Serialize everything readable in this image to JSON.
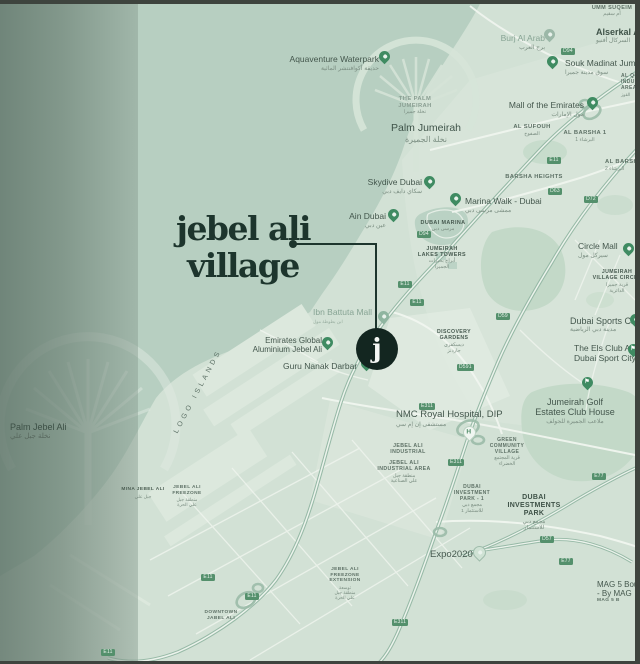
{
  "colors": {
    "accent_dark_green": "#1d352d",
    "pin_green": "#3f8b62",
    "badge_green": "#54906c",
    "water": "#b7cfc1",
    "land": "#d2e1d5",
    "marker_circle": "#132620"
  },
  "title": {
    "line1": "jebel ali",
    "line2": "village"
  },
  "icons": {
    "marker_letter": "j",
    "hospital": "H",
    "golf": "⚑"
  },
  "labels": {
    "aqua": {
      "text": "Aquaventure Waterpark",
      "ar": "حديقة أكوافنتشر المائية"
    },
    "palmSmall": {
      "text": "THE PALM\nJUMEIRAH",
      "ar": "نخلة جميرا"
    },
    "palmJumeirah": {
      "text": "Palm Jumeirah",
      "ar": "نخلة الجميرة"
    },
    "ummSuqeim": {
      "text": "UMM SUQEIM",
      "ar": "أم سقيم"
    },
    "burj": {
      "text": "Burj Al Arab",
      "ar": "برج العرب"
    },
    "alserkal": {
      "text": "Alserkal Avenue",
      "ar": "السركال أفنيو"
    },
    "souk": {
      "text": "Souk Madinat Jumeirah",
      "ar": "سوق مدينة جميرا"
    },
    "moe": {
      "text": "Mall of the Emirates",
      "ar": "مول الإمارات"
    },
    "sufouh": {
      "text": "AL SUFOUH",
      "ar": "الصفوح"
    },
    "barsha1": {
      "text": "AL BARSHA 1",
      "ar": "البرشاء 1"
    },
    "barsha2": {
      "text": "AL BARSHA 2",
      "ar": "البرشاء 2"
    },
    "barshaHeights": {
      "text": "BARSHA HEIGHTS"
    },
    "alquoz": {
      "text": "AL QUOZ\nINDUSTRIAL\nAREA 3",
      "ar": "القوز"
    },
    "skydive": {
      "text": "Skydive Dubai",
      "ar": "سكاي دايف دبي"
    },
    "ain": {
      "text": "Ain Dubai",
      "ar": "عين دبي"
    },
    "marinaWalk": {
      "text": "Marina Walk - Dubai",
      "ar": "ممشى مرسى دبي"
    },
    "dubaiMarina": {
      "text": "DUBAI MARINA",
      "ar": "مرسى دبي"
    },
    "jlt": {
      "text": "JUMEIRAH\nLAKES TOWERS",
      "ar": "أبراج بحيرات\nالجميرا"
    },
    "circleMall": {
      "text": "Circle Mall",
      "ar": "سيركل مول"
    },
    "jvc": {
      "text": "JUMEIRAH\nVILLAGE CIRCLE",
      "ar": "قرية جميرا\nالدائرية"
    },
    "sportsCity": {
      "text": "Dubai Sports City",
      "ar": "مدينة دبي الرياضية"
    },
    "els": {
      "text": "The Els Club At\nDubai Sport City"
    },
    "golfEstates": {
      "text": "Jumeirah Golf\nEstates Club House",
      "ar": "ملاعب الجميرة للجولف"
    },
    "ibnBattuta": {
      "text": "Ibn Battuta Mall",
      "ar": "ابن بطوطة مول"
    },
    "ega": {
      "text": "Emirates Global\nAluminium Jebel Ali"
    },
    "guru": {
      "text": "Guru Nanak Darbar"
    },
    "discovery": {
      "text": "DISCOVERY\nGARDENS",
      "ar": "ديسكفري\nجاردنز"
    },
    "nmc": {
      "text": "NMC Royal Hospital, DIP",
      "ar": "مستشفى إن إم سي"
    },
    "jai": {
      "text": "JEBEL ALI\nINDUSTRIAL"
    },
    "jaia": {
      "text": "JEBEL ALI\nINDUSTRIAL AREA",
      "ar": "منطقة جبل\nعلي الصناعية"
    },
    "greenCommunity": {
      "text": "GREEN\nCOMMUNITY\nVILLAGE",
      "ar": "قرية المجتمع\nالخضراء"
    },
    "dip1": {
      "text": "DUBAI\nINVESTMENT\nPARK - 1",
      "ar": "مجمع دبي\nللاستثمار 1"
    },
    "dip": {
      "text": "DUBAI\nINVESTMENTS\nPARK",
      "ar": "مجمع دبي\nللاستثمار"
    },
    "expo": {
      "text": "Expo2020"
    },
    "palmJebelAli": {
      "text": "Palm Jebel Ali",
      "ar": "نخلة جبل علي"
    },
    "mina": {
      "text": "MINA JEBEL ALI",
      "ar": "جبل علي"
    },
    "freezone": {
      "text": "JEBEL ALI\nFREEZONE",
      "ar": "منطقة جبل\nعلي الحرة"
    },
    "freezoneExt": {
      "text": "JEBEL ALI\nFREEZONE\nEXTENSION",
      "ar": "توسعة\nمنطقة جبل\nعلي الحرة"
    },
    "downtown": {
      "text": "DOWNTOWN\nJABEL ALI"
    },
    "mag5": {
      "text": "MAG 5 Boulevard\n- By MAG",
      "sub": "MAG 5 B"
    },
    "logoIslands": {
      "text": "LOGO ISLANDS"
    }
  },
  "badges": {
    "b1": "D94",
    "b2": "D94",
    "b3": "E11",
    "b4": "E11",
    "b5": "D63",
    "b6": "D72",
    "b7": "E11",
    "b8": "D591",
    "b9": "E311",
    "b10": "D59",
    "b11": "E311",
    "b12": "E77",
    "b13": "D57",
    "b14": "E77",
    "b15": "E311",
    "b16": "E11",
    "b17": "E11",
    "b18": "E11"
  }
}
